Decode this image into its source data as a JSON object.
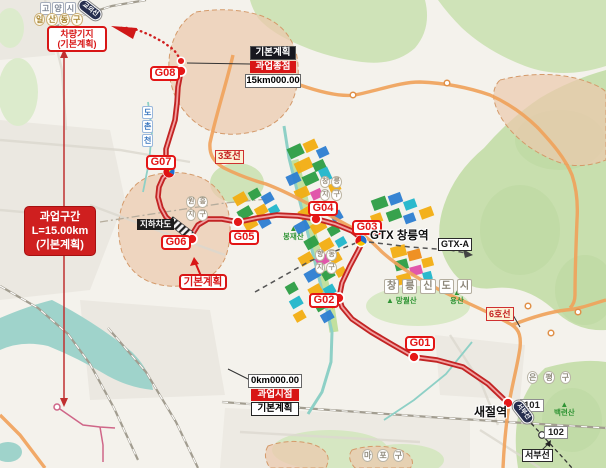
{
  "colors": {
    "route_red": "#cc2424",
    "accent_red": "#d81616",
    "line3_orange": "#f0a35c",
    "water_teal": "#9fd3cb",
    "zone_tan": "#ecc9ad",
    "park_green": "#cfe3b8",
    "block_yellow": "#f3ae12",
    "block_green": "#2d9e45",
    "block_blue": "#2d7fd2",
    "block_teal": "#21b6cc",
    "block_magenta": "#e04fa8"
  },
  "badges": {
    "depot": {
      "line1": "차량기지",
      "line2": "(기본계획)"
    },
    "section": {
      "line1": "과업구간",
      "line2": "L=15.00km",
      "line3": "(기본계획)"
    },
    "endpoint": {
      "plan": "기본계획",
      "name": "과업종점",
      "chainage": "15km000.00"
    },
    "startpoint": {
      "chainage": "0km000.00",
      "name": "과업시점",
      "plan": "기본계획"
    },
    "basic_plan_callout": "기본계획",
    "underpass": "지하차도",
    "line3": "3호선",
    "line6": "6호선",
    "gtx_a": "GTX-A",
    "seobu_line": "서부선",
    "gyoui_line_oval": "교외선",
    "seobu_line_oval": "서부선"
  },
  "stations": {
    "g01": "G01",
    "g02": "G02",
    "g03": "G03",
    "g04": "G04",
    "g05": "G05",
    "g06": "G06",
    "g07": "G07",
    "g08": "G08",
    "gtx_changneung": "GTX 창릉역",
    "saejeol": "새절역",
    "s101": "101",
    "s102": "102"
  },
  "places": {
    "goyang_si": "고양시",
    "ilsan_donggu": "일산동구",
    "eunpyeong_gu": "은평구",
    "mapo_gu": "마포구",
    "changneung_newtown": "창릉신도시",
    "wonheung_district": "원흥지구",
    "changneung_district": "창릉지구",
    "hyangdong_district": "향동지구",
    "stream_dochon": "도촌천",
    "mt_bongjae": "봉재산",
    "mt_mangwol": "망월산",
    "mt_yong": "용산",
    "mt_baengnyeon": "백련산",
    "mountain_icon": "▲"
  }
}
